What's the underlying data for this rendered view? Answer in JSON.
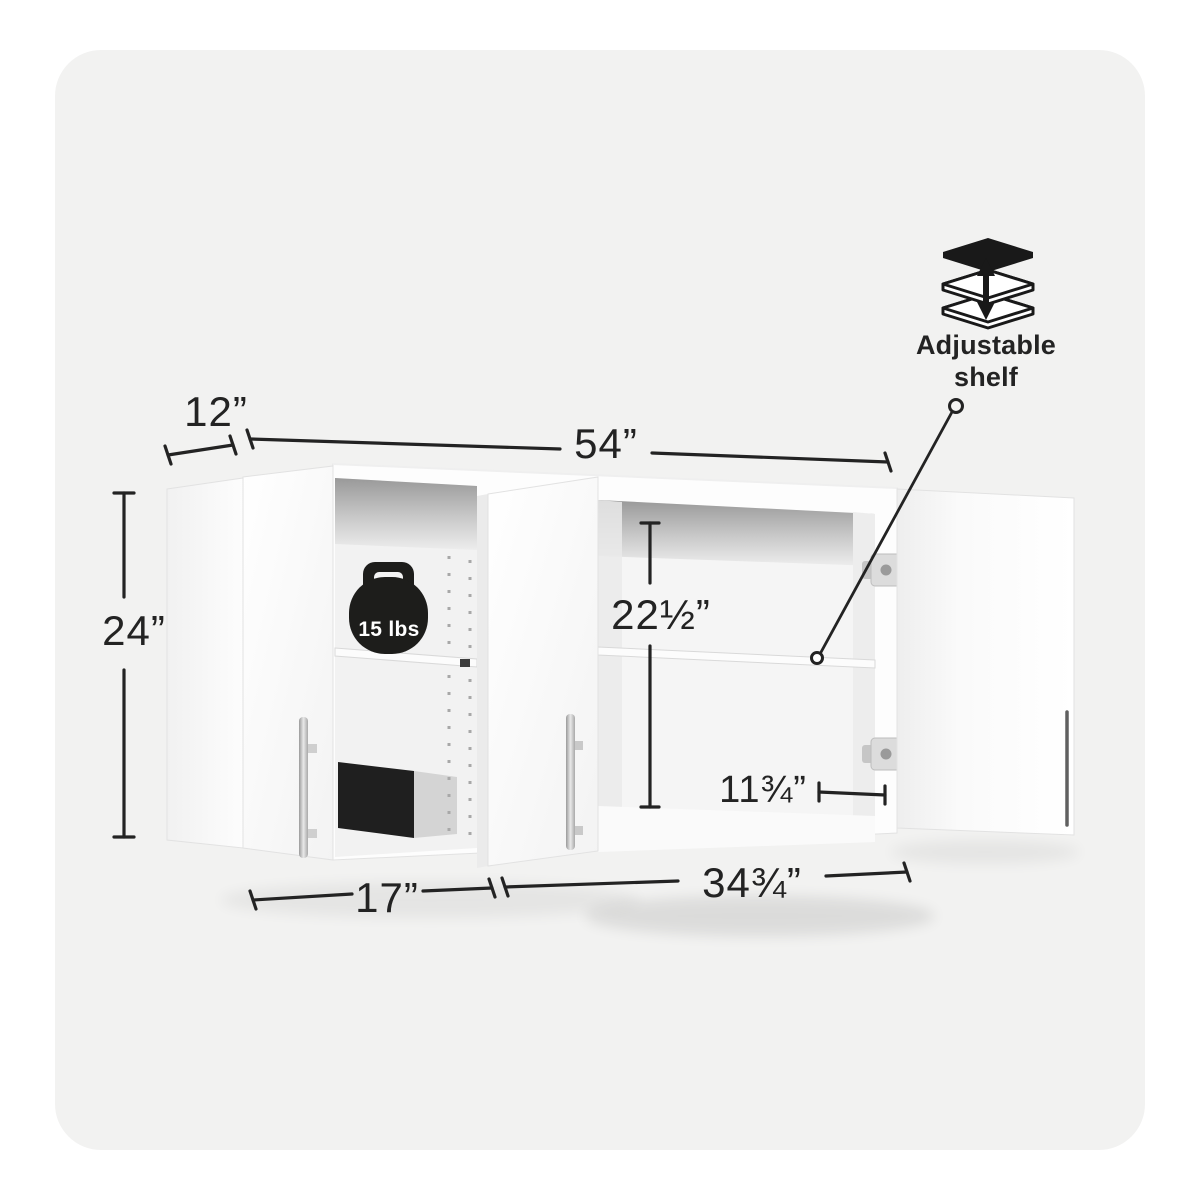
{
  "page": {
    "background_color": "#ffffff",
    "card_color": "#f2f2f1"
  },
  "diagram": {
    "subject": "Wall storage cabinet with open doors, dimension callouts and adjustable shelf",
    "line_color": "#232323",
    "cabinet_color": "#fdfdfd",
    "dimensions": {
      "depth": "12”",
      "overall_width": "54”",
      "overall_height": "24”",
      "interior_height": "22½”",
      "right_door_width": "11¾”",
      "left_section_width": "17”",
      "right_section_width": "34¾”"
    },
    "weight_badge": {
      "label": "15 lbs",
      "badge_color": "#1d1d1b",
      "text_color": "#ffffff"
    },
    "callout": {
      "line1": "Adjustable",
      "line2": "shelf"
    },
    "icons": {
      "weight_badge": "kettlebell-icon",
      "callout": "adjustable-shelf-icon"
    }
  }
}
